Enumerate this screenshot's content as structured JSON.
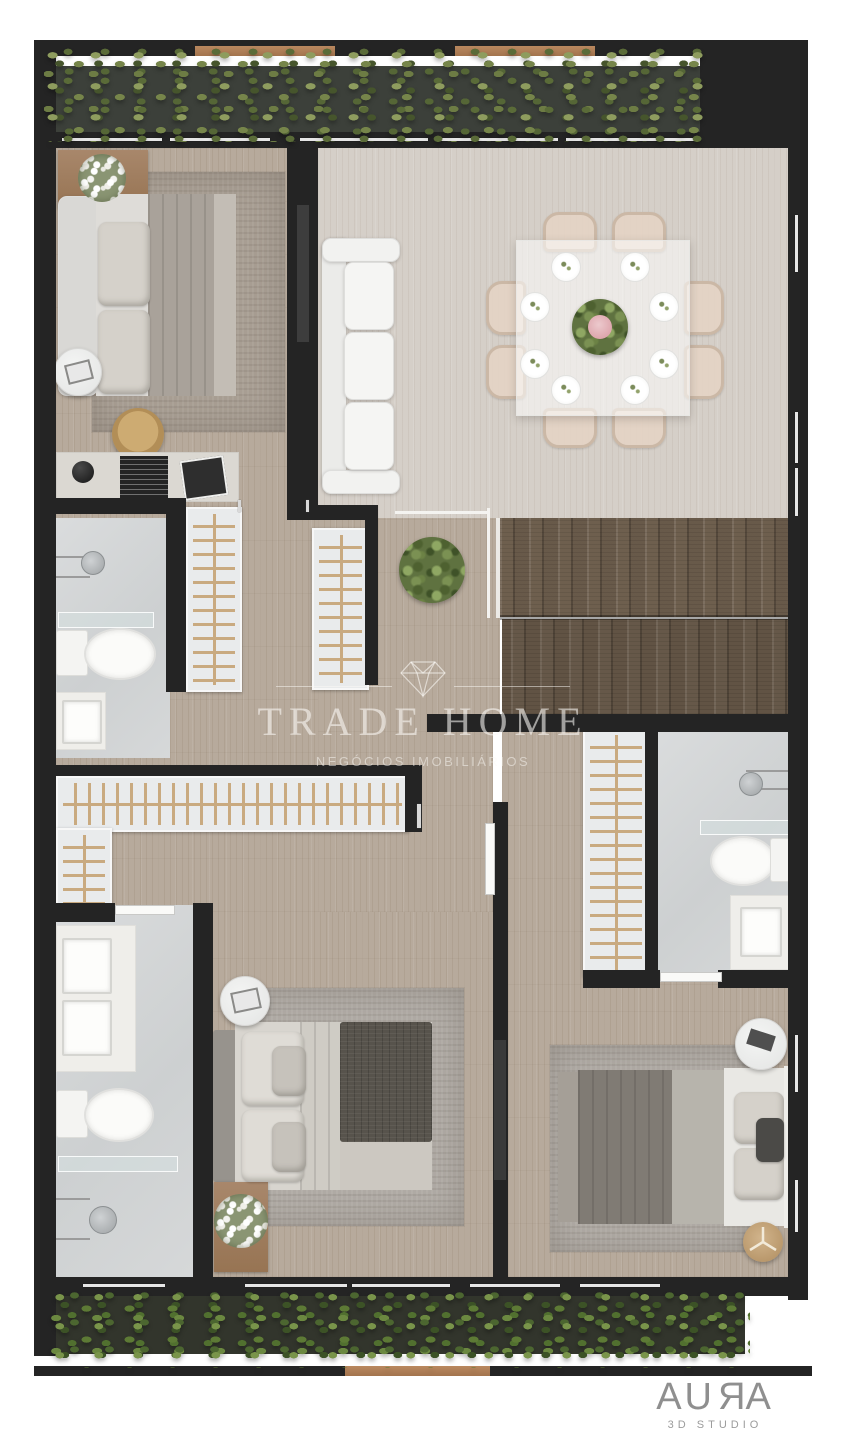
{
  "watermark": {
    "brand": "TRADE HOME",
    "tagline": "NEGÓCIOS IMOBILIÁRIOS",
    "icon": "diamond-icon"
  },
  "studio_logo": {
    "name": "AURA",
    "subtitle": "3D STUDIO"
  },
  "palette": {
    "background": "#ffffff",
    "wall": "#242424",
    "wood_floor": "#b7aa9c",
    "light_floor": "#d5cfc8",
    "bath_floor": "#d3d5d6",
    "stair_wood": "#6e5f4e",
    "hedge_green": "#6b7c44",
    "shrub_green": "#5d7a35",
    "accent_wood": "#a97e5c",
    "closet_rail": "#c9aa80",
    "furniture_white": "#f2f2f0",
    "watermark_white": "rgba(252,250,246,0.58)",
    "logo_gray": "#8f8f8f"
  }
}
